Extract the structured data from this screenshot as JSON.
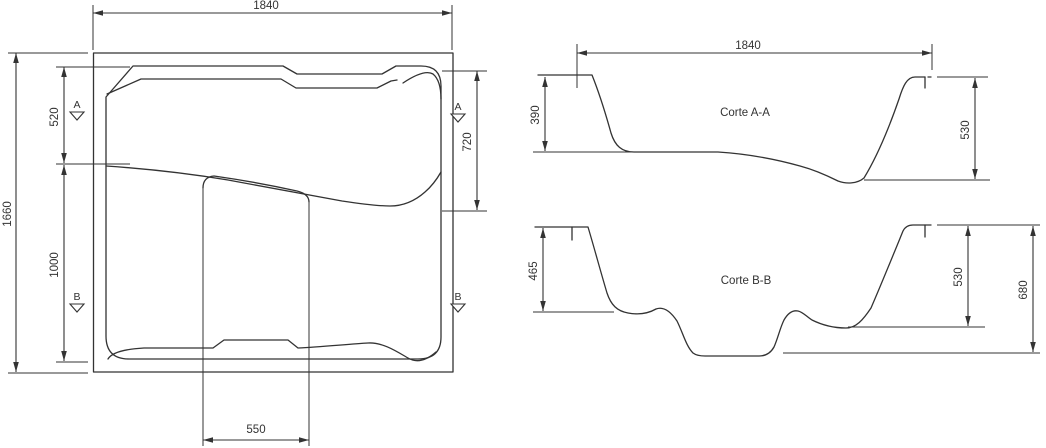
{
  "plan": {
    "dim_width": "1840",
    "dim_height": "1660",
    "dim_upper_left": "520",
    "dim_lower_left": "1000",
    "dim_right": "720",
    "dim_bottom": "550",
    "section_a_label": "A",
    "section_b_label": "B"
  },
  "section_aa": {
    "title": "Corte A-A",
    "dim_width": "1840",
    "dim_depth_left": "390",
    "dim_depth_right": "530"
  },
  "section_bb": {
    "title": "Corte B-B",
    "dim_depth_left": "465",
    "dim_depth_seat": "530",
    "dim_depth_total": "680"
  },
  "colors": {
    "line": "#333333",
    "background": "#ffffff"
  }
}
